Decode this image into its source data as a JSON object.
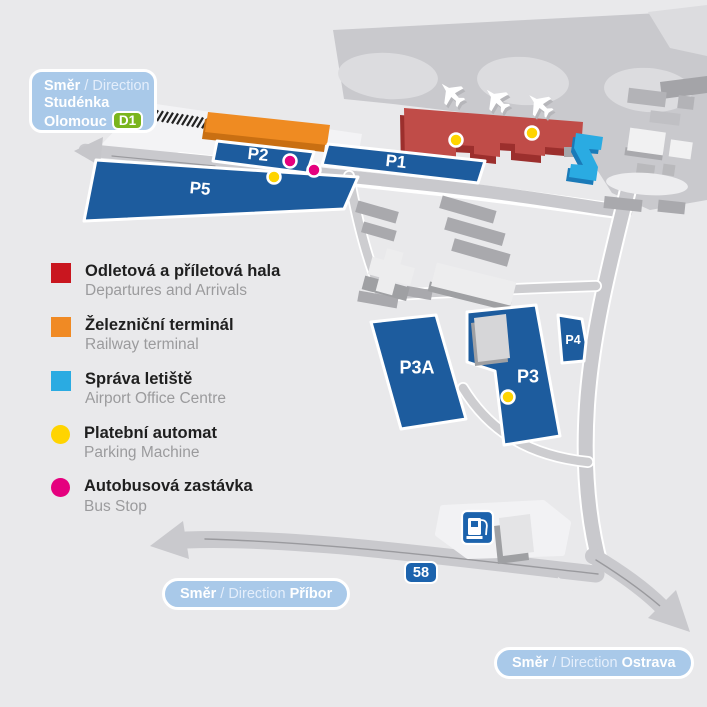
{
  "signs": {
    "olomouc": {
      "prefix": "Směr",
      "separator": "/ Direction",
      "city1": "Studénka",
      "city2": "Olomouc",
      "badge": "D1"
    },
    "pribor": {
      "prefix": "Směr",
      "separator": "/ Direction",
      "city": "Příbor"
    },
    "ostrava": {
      "prefix": "Směr",
      "separator": "/ Direction",
      "city": "Ostrava"
    },
    "road_number": "58"
  },
  "parking": {
    "p1": "P1",
    "p2": "P2",
    "p3": "P3",
    "p3a": "P3A",
    "p4": "P4",
    "p5": "P5"
  },
  "legend": {
    "items": [
      {
        "czech": "Odletová a příletová hala",
        "english": "Departures and Arrivals",
        "color": "#c9161f",
        "shape": "square"
      },
      {
        "czech": "Železniční terminál",
        "english": "Railway terminal",
        "color": "#f08a24",
        "shape": "square"
      },
      {
        "czech": "Správa letiště",
        "english": "Airport Office Centre",
        "color": "#2aabe2",
        "shape": "square"
      },
      {
        "czech": "Platební automat",
        "english": "Parking Machine",
        "color": "#ffd400",
        "shape": "circle"
      },
      {
        "czech": "Autobusová zastávka",
        "english": "Bus Stop",
        "color": "#e5007e",
        "shape": "circle"
      }
    ]
  },
  "icons": {
    "airplane": "✈",
    "fuel_station": "⛽",
    "railway_track": "#"
  },
  "colors": {
    "parking_lot_blue": "#1d5c9e",
    "departures_hall_red": "#c04c48",
    "railway_terminal_orange": "#ef8b22",
    "airport_office_blue": "#2aabe2",
    "parking_machine_yellow": "#ffd400",
    "bus_stop_pink": "#e5007e",
    "direction_sign_blue": "#a9c9e9",
    "road_badge_blue": "#1c63ad",
    "d1_badge_green": "#7ab51d"
  }
}
